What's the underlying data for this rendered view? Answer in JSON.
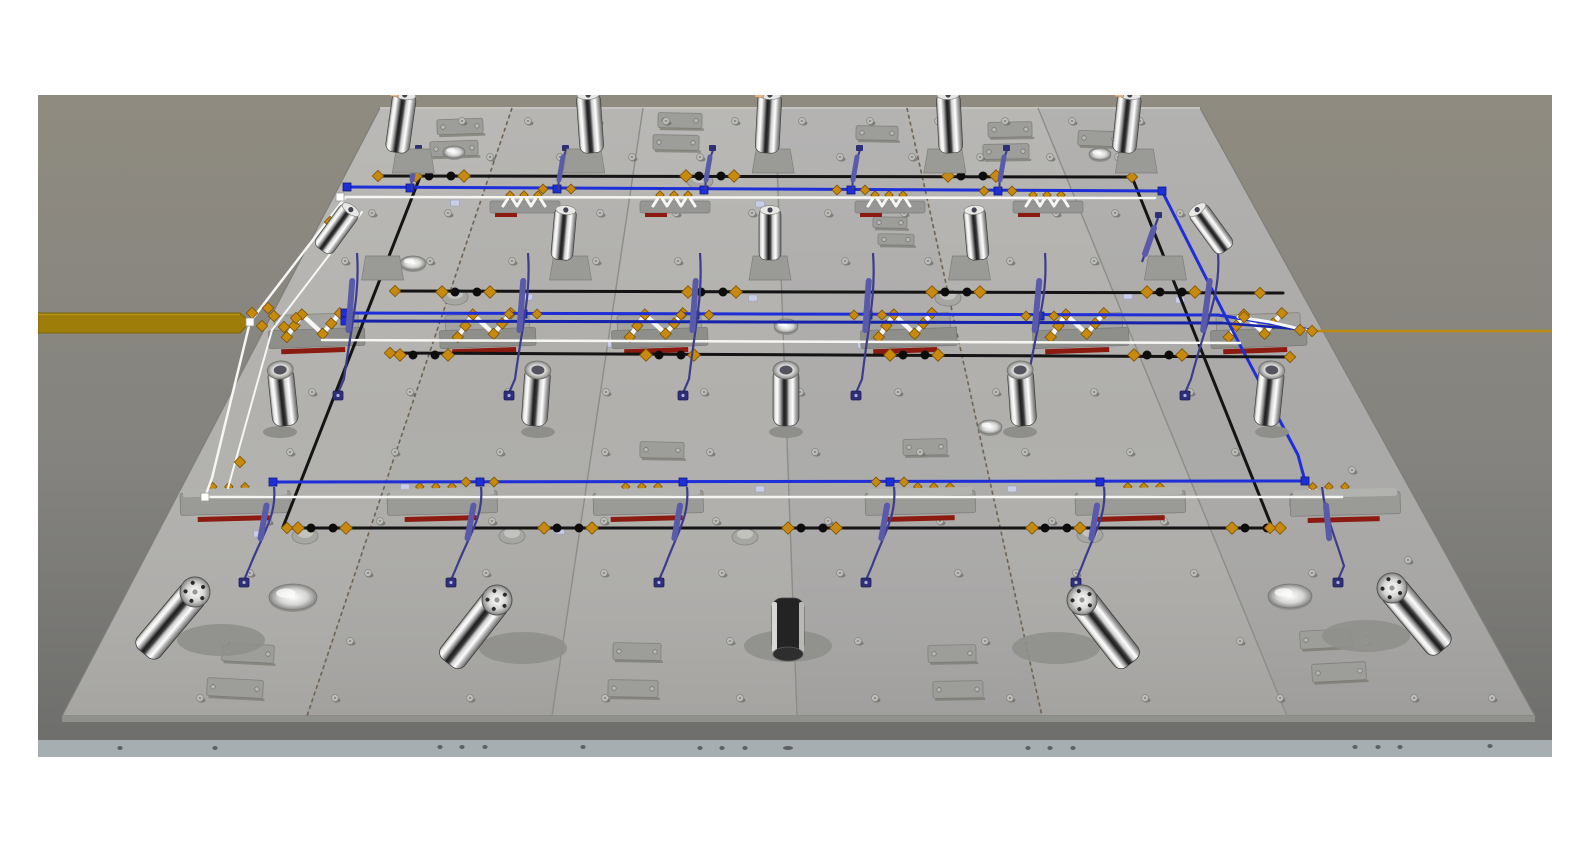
{
  "viewport": {
    "x": 38,
    "y": 95,
    "w": 1514,
    "h": 662,
    "page_bg": "#ffffff"
  },
  "colors": {
    "bg_top": "#8f8b80",
    "bg_mid": "#84837f",
    "bg_bottom": "#6d6d6b",
    "seam": "#8c8c88",
    "seam_dashed": "#6f6251",
    "plate_edge": "#90908c",
    "front_band": "#a7aeb1",
    "band_dot": "#5e6164",
    "blue": "#1e2fd8",
    "blue_dark": "#1522aa",
    "black": "#141414",
    "white_tube": "#f6f6f4",
    "purple": "#5a5aaa",
    "purple_dark": "#3c3c8c",
    "purple_conn": "#2f2f78",
    "orange_fit": "#c8890f",
    "orange_fit_light": "#eaa81e",
    "orange_band": "#9e7d08",
    "orange_line": "#bb8a10",
    "red_stripe": "#8b1a10",
    "pad": "#9d9d9a",
    "pad_stroke": "#7f7f7b",
    "screw": "#c6c6c3",
    "screw_stroke": "#8a8a86",
    "screw_shadow": "#6e6e6b",
    "clip": "#c9cde6",
    "base_gray": "#9a9a97",
    "base_dark": "#8e8e8b",
    "tan_tip": "#e0b88c"
  },
  "plate": {
    "corners": [
      [
        380,
        108
      ],
      [
        1200,
        108
      ],
      [
        1535,
        716
      ],
      [
        62,
        716
      ]
    ],
    "panel_fills": [
      "#b2b1ae",
      "#aeadaa",
      "#b1b0ad",
      "#acabaa",
      "#b0afac",
      "#aaa9a7"
    ],
    "seams": [
      {
        "top": 512,
        "bottom": 307,
        "dashed": true
      },
      {
        "top": 643,
        "bottom": 552,
        "dashed": false
      },
      {
        "top": 775,
        "bottom": 797,
        "dashed": false
      },
      {
        "top": 907,
        "bottom": 1042,
        "dashed": true
      },
      {
        "top": 1038,
        "bottom": 1287,
        "dashed": false
      }
    ],
    "front_band": {
      "y": 740,
      "h": 17,
      "dots": [
        [
          120,
          748
        ],
        [
          215,
          748
        ],
        [
          440,
          747
        ],
        [
          462,
          747
        ],
        [
          485,
          747
        ],
        [
          583,
          747
        ],
        [
          700,
          748
        ],
        [
          722,
          748
        ],
        [
          745,
          748
        ],
        [
          788,
          748
        ],
        [
          1028,
          748
        ],
        [
          1050,
          748
        ],
        [
          1073,
          748
        ],
        [
          1355,
          747
        ],
        [
          1378,
          747
        ],
        [
          1400,
          747
        ],
        [
          1490,
          746
        ]
      ]
    }
  },
  "orange_band": {
    "points": [
      [
        38,
        313
      ],
      [
        240,
        313
      ],
      [
        250,
        322
      ],
      [
        240,
        333
      ],
      [
        38,
        333
      ]
    ]
  },
  "orange_line": {
    "pts": [
      [
        1312,
        331
      ],
      [
        1552,
        331
      ]
    ]
  },
  "tubes": [
    {
      "name": "black-diagonal-left",
      "c": "black",
      "w": 3,
      "pts": [
        [
          420,
          177
        ],
        [
          283,
          527
        ]
      ]
    },
    {
      "name": "black-diagonal-right",
      "c": "black",
      "w": 3,
      "pts": [
        [
          1132,
          177
        ],
        [
          1272,
          527
        ]
      ]
    },
    {
      "name": "back-black-line",
      "c": "black",
      "w": 3,
      "pts": [
        [
          378,
          176
        ],
        [
          1132,
          177
        ]
      ]
    },
    {
      "name": "back-blue-line",
      "c": "blue",
      "w": 3,
      "pts": [
        [
          347,
          187
        ],
        [
          1162,
          191
        ]
      ]
    },
    {
      "name": "blue-diagonal-right",
      "c": "blue",
      "w": 3,
      "pts": [
        [
          1162,
          191
        ],
        [
          1240,
          345
        ],
        [
          1298,
          455
        ],
        [
          1305,
          481
        ]
      ]
    },
    {
      "name": "back-white-line",
      "c": "white_tube",
      "w": 2.5,
      "pts": [
        [
          340,
          197
        ],
        [
          1155,
          198
        ]
      ]
    },
    {
      "name": "left-white-diagonal",
      "c": "white_tube",
      "w": 2.5,
      "pts": [
        [
          345,
          198
        ],
        [
          250,
          322
        ],
        [
          212,
          478
        ],
        [
          205,
          497
        ]
      ]
    },
    {
      "name": "left-white-diagonal-2",
      "c": "white_tube",
      "w": 2,
      "pts": [
        [
          362,
          212
        ],
        [
          272,
          330
        ],
        [
          228,
          488
        ]
      ]
    },
    {
      "name": "mid-black-upper",
      "c": "black",
      "w": 3,
      "pts": [
        [
          395,
          291
        ],
        [
          1283,
          293
        ]
      ]
    },
    {
      "name": "mid-blue-upper",
      "c": "blue",
      "w": 3,
      "pts": [
        [
          345,
          313
        ],
        [
          1218,
          315
        ]
      ]
    },
    {
      "name": "mid-blue-lower",
      "c": "blue_dark",
      "w": 3,
      "pts": [
        [
          345,
          321
        ],
        [
          1222,
          323
        ]
      ]
    },
    {
      "name": "blue-merge-a",
      "c": "blue",
      "w": 3,
      "pts": [
        [
          1218,
          315
        ],
        [
          1310,
          330
        ]
      ]
    },
    {
      "name": "blue-merge-b",
      "c": "blue_dark",
      "w": 2.5,
      "pts": [
        [
          1222,
          323
        ],
        [
          1310,
          330
        ]
      ]
    },
    {
      "name": "mid-white-line",
      "c": "white_tube",
      "w": 2.5,
      "pts": [
        [
          322,
          340
        ],
        [
          1240,
          343
        ]
      ]
    },
    {
      "name": "right-white-curve",
      "c": "white_tube",
      "w": 3,
      "pts": [
        [
          1238,
          317
        ],
        [
          1270,
          322
        ],
        [
          1296,
          328
        ],
        [
          1310,
          331
        ]
      ]
    },
    {
      "name": "mid-black-lower",
      "c": "black",
      "w": 3,
      "pts": [
        [
          388,
          353
        ],
        [
          1292,
          357
        ]
      ]
    },
    {
      "name": "front-blue-line",
      "c": "blue",
      "w": 3,
      "pts": [
        [
          273,
          482
        ],
        [
          1305,
          481
        ]
      ]
    },
    {
      "name": "front-white-line",
      "c": "white_tube",
      "w": 2.5,
      "pts": [
        [
          205,
          497
        ],
        [
          1342,
          497
        ]
      ]
    },
    {
      "name": "front-black-line",
      "c": "black",
      "w": 3,
      "pts": [
        [
          287,
          528
        ],
        [
          1270,
          528
        ]
      ]
    }
  ],
  "node_pairs": [
    {
      "y": 176,
      "xs": [
        440,
        710,
        972
      ]
    },
    {
      "y": 292,
      "xs": [
        466,
        712,
        956,
        1171
      ]
    },
    {
      "y": 355,
      "xs": [
        424,
        670,
        914,
        1158
      ]
    },
    {
      "y": 528,
      "xs": [
        322,
        568,
        812,
        1056,
        1256
      ]
    }
  ],
  "end_diamonds": [
    [
      378,
      176
    ],
    [
      1132,
      177
    ],
    [
      395,
      291
    ],
    [
      1260,
      293
    ],
    [
      390,
      353
    ],
    [
      1290,
      357
    ],
    [
      287,
      528
    ],
    [
      1270,
      528
    ],
    [
      1312,
      331
    ],
    [
      1244,
      317
    ],
    [
      1300,
      330
    ],
    [
      330,
      222
    ],
    [
      268,
      308
    ],
    [
      240,
      462
    ],
    [
      252,
      313
    ],
    [
      262,
      326
    ],
    [
      274,
      316
    ],
    [
      284,
      327
    ],
    [
      296,
      318
    ]
  ],
  "blue_squares": [
    [
      347,
      187
    ],
    [
      410,
      188
    ],
    [
      557,
      189
    ],
    [
      704,
      190
    ],
    [
      851,
      190
    ],
    [
      998,
      191
    ],
    [
      1162,
      191
    ],
    [
      345,
      313
    ],
    [
      345,
      321
    ],
    [
      523,
      314
    ],
    [
      695,
      315
    ],
    [
      868,
      315
    ],
    [
      1040,
      316
    ],
    [
      273,
      482
    ],
    [
      480,
      482
    ],
    [
      683,
      482
    ],
    [
      890,
      482
    ],
    [
      1100,
      482
    ],
    [
      1305,
      481
    ]
  ],
  "blue_node_diamonds": [
    [
      523,
      314
    ],
    [
      695,
      315
    ],
    [
      868,
      315
    ],
    [
      1040,
      316
    ],
    [
      480,
      482
    ],
    [
      890,
      482
    ],
    [
      557,
      189
    ],
    [
      851,
      190
    ],
    [
      998,
      191
    ]
  ],
  "white_squares": [
    [
      340,
      197
    ],
    [
      205,
      497
    ],
    [
      250,
      322
    ]
  ],
  "gray_pods": [
    [
      305,
      532
    ],
    [
      512,
      532
    ],
    [
      745,
      533
    ],
    [
      1090,
      531
    ],
    [
      455,
      293
    ],
    [
      948,
      294
    ],
    [
      700,
      177
    ]
  ],
  "hoses": {
    "minis_back": {
      "xs": [
        410,
        557,
        704,
        851,
        998
      ],
      "y1": 150,
      "y2": 190
    },
    "mini_right": {
      "x1": 1158,
      "y1": 218,
      "x2": 1142,
      "y2": 262
    },
    "mid": {
      "cols": [
        352,
        523,
        695,
        868,
        1040,
        1213
      ],
      "y1": 253,
      "y2": 393,
      "drift": [
        -14,
        -14,
        -12,
        -12,
        -18,
        -28
      ]
    },
    "front": {
      "cols": [
        270,
        477,
        683,
        890,
        1100,
        1318
      ],
      "y1": 487,
      "y2": 580,
      "drift": [
        -26,
        -26,
        -24,
        -24,
        -24,
        20
      ]
    }
  },
  "cylinders": {
    "back": [
      {
        "x": 405,
        "t": 8,
        "tan": true
      },
      {
        "x": 588,
        "t": -4,
        "tan": false
      },
      {
        "x": 770,
        "t": 3,
        "tan": true
      },
      {
        "x": 948,
        "t": -3,
        "tan": false
      },
      {
        "x": 1130,
        "t": 6,
        "tan": true
      }
    ],
    "row1": [
      {
        "x": 352,
        "t": 36
      },
      {
        "x": 566,
        "t": 5
      },
      {
        "x": 770,
        "t": 0
      },
      {
        "x": 974,
        "t": -5
      },
      {
        "x": 1196,
        "t": -36
      }
    ],
    "row2": [
      {
        "x": 280,
        "t": -6
      },
      {
        "x": 538,
        "t": 4
      },
      {
        "x": 786,
        "t": 0
      },
      {
        "x": 1020,
        "t": -4
      },
      {
        "x": 1272,
        "t": 6
      }
    ],
    "front": [
      {
        "x": 195,
        "y": 592,
        "a": 40
      },
      {
        "x": 497,
        "y": 600,
        "a": 38
      },
      {
        "x": 788,
        "y": 598,
        "a": 0,
        "dark": true
      },
      {
        "x": 1082,
        "y": 600,
        "a": -38
      },
      {
        "x": 1392,
        "y": 588,
        "a": -40
      }
    ]
  },
  "clamps": {
    "mid_x": [
      316,
      487,
      659,
      908,
      1080,
      1258
    ],
    "mid_y": 316,
    "back_zigzag_x": [
      525,
      675,
      890,
      1048
    ],
    "back_zigzag_y": 197,
    "front_bases": [
      [
        235,
        492
      ],
      [
        442,
        492
      ],
      [
        648,
        492
      ],
      [
        920,
        492
      ],
      [
        1130,
        492
      ],
      [
        1345,
        493
      ]
    ],
    "front_zigzags": [
      [
        230,
        489
      ],
      [
        437,
        489
      ],
      [
        643,
        489
      ],
      [
        935,
        489
      ],
      [
        1145,
        489
      ],
      [
        1330,
        489
      ]
    ]
  },
  "pads": [
    [
      437,
      119,
      46,
      15,
      -2
    ],
    [
      430,
      141,
      48,
      15,
      -2
    ],
    [
      658,
      113,
      44,
      15,
      1
    ],
    [
      653,
      135,
      46,
      15,
      1
    ],
    [
      856,
      126,
      42,
      14,
      1
    ],
    [
      988,
      122,
      44,
      15,
      -1
    ],
    [
      983,
      144,
      46,
      15,
      -1
    ],
    [
      1078,
      131,
      42,
      15,
      2
    ],
    [
      873,
      217,
      34,
      11,
      1
    ],
    [
      878,
      234,
      36,
      11,
      1
    ],
    [
      640,
      442,
      44,
      16,
      1
    ],
    [
      903,
      439,
      44,
      16,
      -1
    ],
    [
      222,
      644,
      52,
      18,
      3
    ],
    [
      207,
      679,
      56,
      18,
      3
    ],
    [
      613,
      643,
      48,
      17,
      1
    ],
    [
      608,
      680,
      50,
      17,
      1
    ],
    [
      928,
      645,
      48,
      17,
      -1
    ],
    [
      933,
      681,
      50,
      17,
      -1
    ],
    [
      1300,
      630,
      52,
      18,
      -3
    ],
    [
      1312,
      663,
      54,
      18,
      -3
    ]
  ],
  "bosses": [
    [
      454,
      152,
      11,
      6
    ],
    [
      1100,
      154,
      11,
      6
    ],
    [
      413,
      263,
      13,
      7
    ],
    [
      786,
      326,
      12,
      7
    ],
    [
      990,
      427,
      12,
      7
    ],
    [
      293,
      597,
      24,
      13
    ],
    [
      1290,
      596,
      22,
      12
    ]
  ],
  "screw_rows": [
    {
      "y": 121,
      "xs": [
        392,
        462,
        528,
        598,
        666,
        735,
        802,
        870,
        938,
        1005,
        1072,
        1140
      ]
    },
    {
      "y": 157,
      "xs": [
        418,
        490,
        560,
        632,
        700,
        772,
        840,
        912,
        980,
        1050,
        1118
      ]
    },
    {
      "y": 213,
      "xs": [
        372,
        448,
        600,
        676,
        752,
        828,
        904,
        1056,
        1115,
        1180
      ]
    },
    {
      "y": 261,
      "xs": [
        345,
        430,
        512,
        596,
        678,
        762,
        845,
        928,
        1010,
        1094,
        1176
      ]
    },
    {
      "y": 392,
      "xs": [
        312,
        410,
        508,
        606,
        704,
        800,
        898,
        996,
        1094,
        1190
      ]
    },
    {
      "y": 452,
      "xs": [
        290,
        395,
        500,
        605,
        710,
        815,
        920,
        1025,
        1130,
        1235
      ]
    },
    {
      "y": 521,
      "xs": [
        268,
        380,
        492,
        604,
        716,
        828,
        940,
        1052,
        1164
      ]
    },
    {
      "y": 573,
      "xs": [
        250,
        368,
        486,
        604,
        722,
        840,
        958,
        1076,
        1194,
        1312
      ]
    },
    {
      "y": 641,
      "xs": [
        225,
        350,
        478,
        730,
        858,
        985,
        1112,
        1240,
        1366
      ]
    },
    {
      "y": 698,
      "xs": [
        200,
        335,
        470,
        605,
        740,
        875,
        1010,
        1145,
        1280,
        1414,
        1492
      ]
    },
    {
      "y": 470,
      "xs": [
        1352
      ]
    },
    {
      "y": 560,
      "xs": [
        1408
      ]
    }
  ],
  "clips": [
    [
      455,
      203
    ],
    [
      760,
      204
    ],
    [
      1063,
      205
    ],
    [
      528,
      297
    ],
    [
      753,
      298
    ],
    [
      1128,
      296
    ],
    [
      612,
      344
    ],
    [
      862,
      345
    ],
    [
      1108,
      344
    ],
    [
      405,
      487
    ],
    [
      760,
      489
    ],
    [
      1012,
      489
    ],
    [
      258,
      534
    ],
    [
      560,
      531
    ],
    [
      1180,
      300
    ]
  ]
}
